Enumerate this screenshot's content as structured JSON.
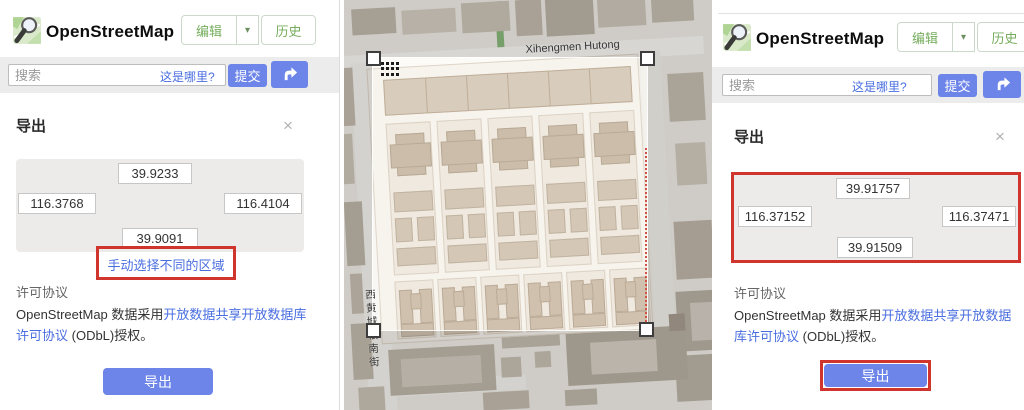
{
  "brand": {
    "title": "OpenStreetMap"
  },
  "nav": {
    "edit": "编辑",
    "caret": "▾",
    "history": "历史"
  },
  "search": {
    "placeholder": "搜索",
    "where_link": "这是哪里?",
    "submit": "提交",
    "directions_icon": "directions-arrow-icon"
  },
  "export_panel": {
    "title": "导出",
    "close_icon": "×",
    "manual_select_link": "手动选择不同的区域",
    "license_heading": "许可协议",
    "license_pre": "OpenStreetMap 数据采用",
    "license_link": "开放数据共享开放数据库许可协议",
    "license_post": " (ODbL)授权。",
    "export_button": "导出"
  },
  "left_panel": {
    "coords": {
      "top": "39.9233",
      "left": "116.3768",
      "right": "116.4104",
      "bottom": "39.9091"
    }
  },
  "right_panel": {
    "coords": {
      "top": "39.91757",
      "left": "116.37152",
      "right": "116.37471",
      "bottom": "39.91509"
    }
  },
  "map": {
    "street_top": "Xihengmen Hutong",
    "street_left": "西黄城根南街"
  },
  "colors": {
    "accent_blue": "#6d85e9",
    "link_blue": "#4a6ee0",
    "brand_green": "#76ad5c",
    "highlight_red": "#cf352c"
  }
}
